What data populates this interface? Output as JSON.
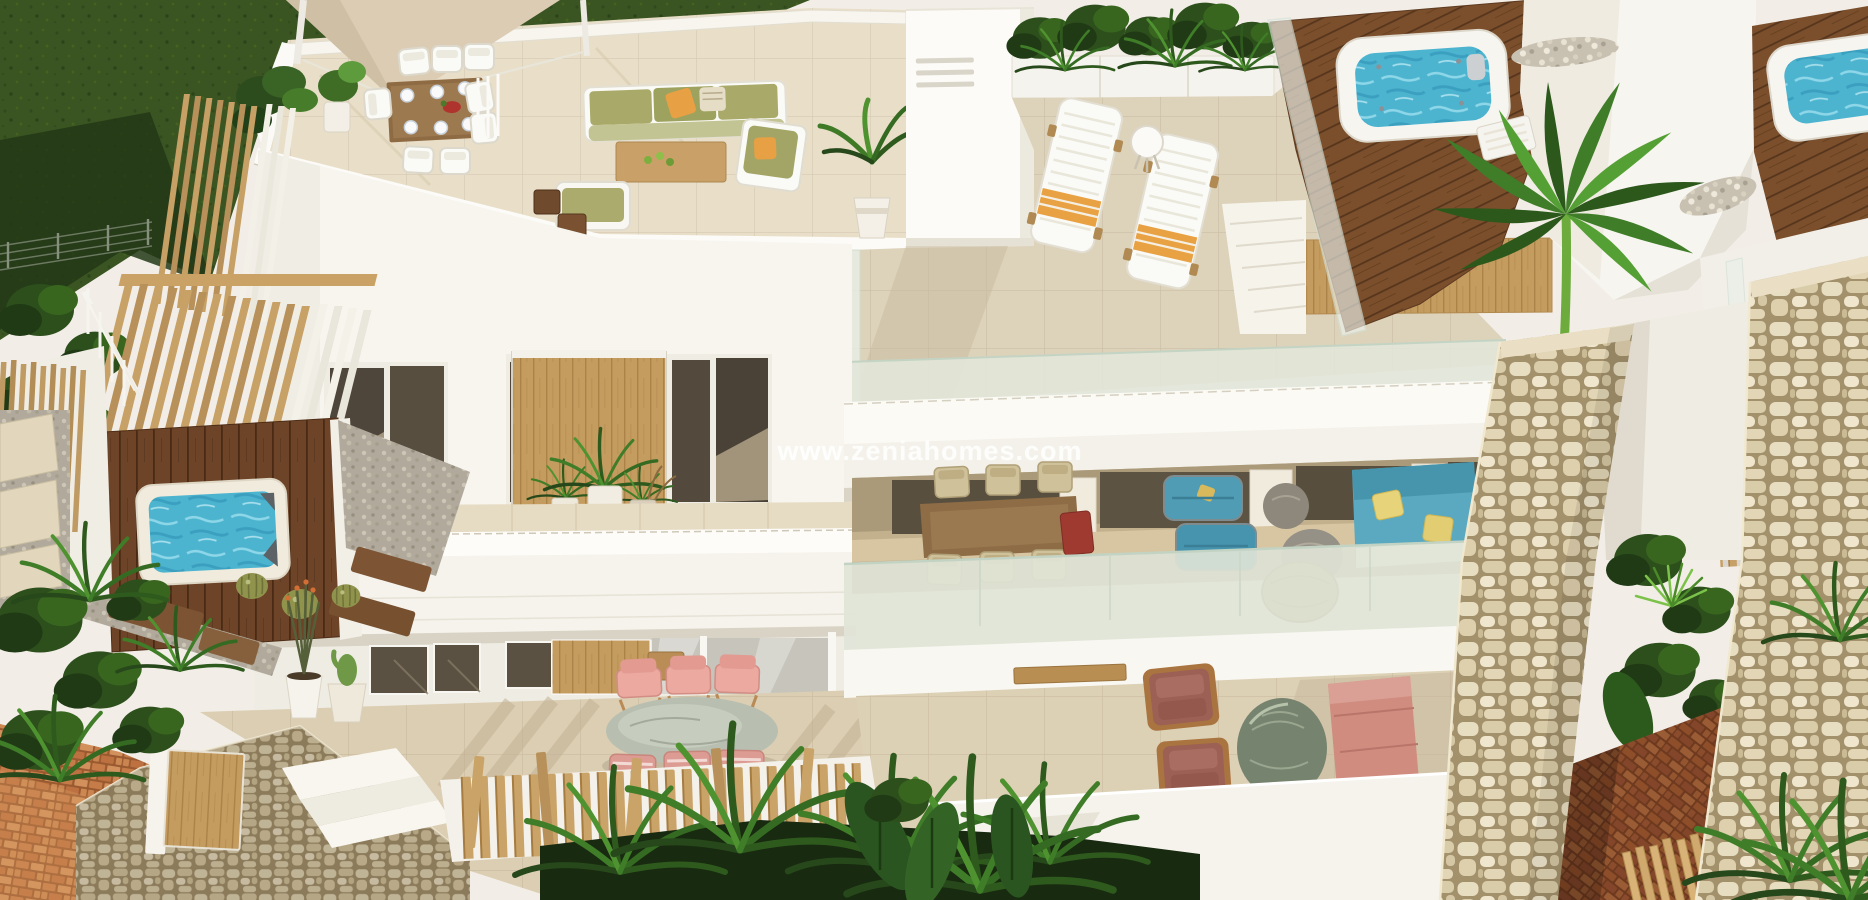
{
  "meta": {
    "type": "3d-architectural-render",
    "subject": "Aerial 3D rendering of a modern white Mediterranean villa complex with rooftop terraces, jacuzzis, plunge pool, pergolas and furnished gardens"
  },
  "watermark": {
    "text": "www.zeniahomes.com"
  },
  "palette": {
    "wall_white": "#f6f4ee",
    "tile_beige": "#ddd2ba",
    "grass_green": "#3a5522",
    "wood_louver": "#c7a166",
    "deck_brown": "#6e4428",
    "water_blue": "#4fb6d2",
    "stone_beige": "#e7ddc1",
    "brick_terracotta": "#c67c48",
    "teal_sofa": "#57a6bd",
    "olive_cushion": "#a9aa69",
    "pink_chair": "#ecaba3",
    "mauve_armchair": "#9c6054",
    "orange_accent": "#e7a044",
    "foliage_dark": "#203a15"
  },
  "scene": {
    "regions": [
      {
        "name": "lawn",
        "description": "dark green grass lawn, top left, with wire garden fence"
      },
      {
        "name": "sail-canopy",
        "description": "beige shade sail over roof terrace corner"
      },
      {
        "name": "roof-terrace",
        "description": "tiled roof terrace with wooden dining table, white chairs and plates"
      },
      {
        "name": "roof-lounge",
        "description": "white garden sofa set with olive green cushions, orange pillows, wooden coffee table"
      },
      {
        "name": "chimney",
        "description": "white chimney block with three vent grooves"
      },
      {
        "name": "planter-boxes",
        "description": "white planters with tropical plants along upper terrace"
      },
      {
        "name": "sun-loungers",
        "description": "two white sun loungers with orange towels and round side table"
      },
      {
        "name": "jacuzzi-left",
        "description": "white square jacuzzi with blue water on dark wooden deck"
      },
      {
        "name": "jacuzzi-right",
        "description": "second jacuzzi on wooden deck at far top right"
      },
      {
        "name": "stair-volume",
        "description": "white roof access volumes with pebble beds and palm tree"
      },
      {
        "name": "upper-terrace",
        "description": "beige tiled upper terrace with glass balustrade"
      },
      {
        "name": "balcony",
        "description": "upper floor balcony with dark glazing, sliding wood panel and potted plants"
      },
      {
        "name": "pergola",
        "description": "angled wooden louver screen on left side of villa"
      },
      {
        "name": "plunge-pool",
        "description": "small blue plunge pool with dark wood deck and gravel"
      },
      {
        "name": "covered-terrace",
        "description": "ground floor covered terrace with wooden dining set, teal armchairs, teal sofa with yellow pillows"
      },
      {
        "name": "patio-right",
        "description": "patio with two mauve wood-frame armchairs, oval stone table and pink sofa"
      },
      {
        "name": "pink-terrace",
        "description": "terrace with pink sling chairs and oval terrazzo table"
      },
      {
        "name": "picket-fence",
        "description": "irregular wooden picket fence along front garden"
      },
      {
        "name": "stone-pillars",
        "description": "two rustic beige stone-clad pillars framing the entrance path"
      },
      {
        "name": "brick-paths",
        "description": "terracotta brick paving at bottom left and between pillars"
      },
      {
        "name": "garden-plants",
        "description": "tropical planting: palms, banana leaves, cacti and barrel cactus pots"
      },
      {
        "name": "watermark",
        "description": "semi-transparent white website watermark centered on facade"
      }
    ]
  }
}
